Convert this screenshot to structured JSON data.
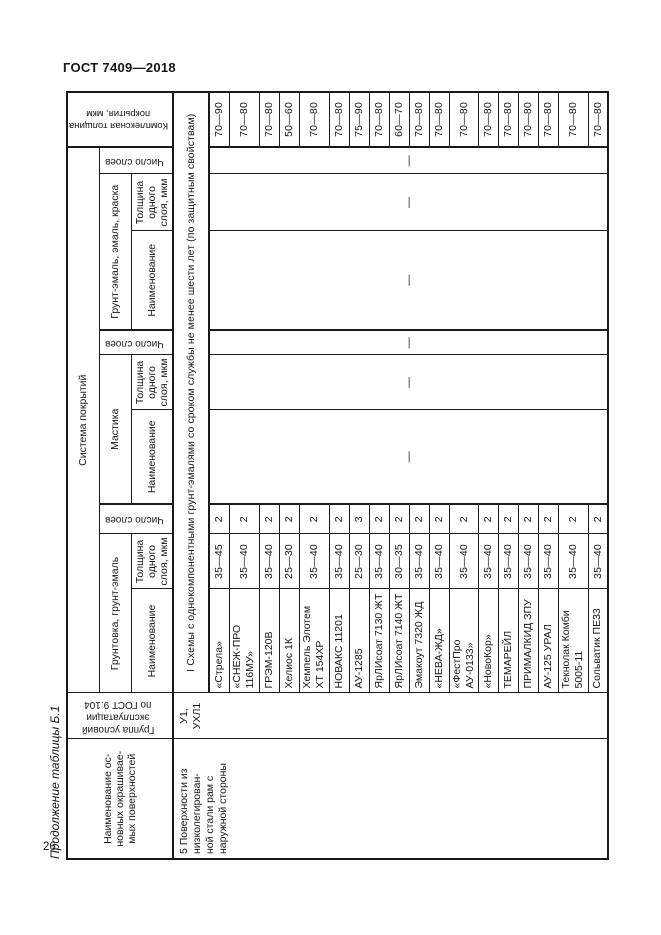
{
  "page": {
    "doc_code": "ГОСТ 7409—2018",
    "page_number": "26",
    "table_caption": "Продолжение таблицы Б.1"
  },
  "table": {
    "headers": {
      "surfaces": "Наименование ос-\nновных окрашивае-\nмых поверхностей",
      "service_group": "Группа условий\nэксплуатации\nпо ГОСТ 9.104",
      "system": "Система покрытий",
      "total_thickness": "Комплексная толщина\nпокрытия, мкм",
      "name": "Наименование",
      "layer_thickness": "Толщина\nодного\nслоя, мкм",
      "layer_count": "Число слоев",
      "group_primer": "Грунтовка, грунт-эмаль",
      "group_mastic": "Мастика",
      "group_enamel": "Грунт-эмаль, эмаль, краска"
    },
    "section_label": "I Схемы с однокомпонентными грунт-эмалями со сроком службы не менее шести лет (по защитным свойствам)",
    "row_group": {
      "surface": "5 Поверхности из\nнизколегирован-\nной стали рам с\nнаружной стороны",
      "conditions": "У1,\nУХЛ1"
    },
    "dash": "—",
    "rows": [
      {
        "name": "«Стрела»",
        "thickness": "35—45",
        "layers": "2",
        "total": "70—90"
      },
      {
        "name": "«СНЕЖ-ПРО\n116МУ»",
        "thickness": "35—40",
        "layers": "2",
        "total": "70—80"
      },
      {
        "name": "ГРЭМ-120В",
        "thickness": "35—40",
        "layers": "2",
        "total": "70—80"
      },
      {
        "name": "Хелиос 1К",
        "thickness": "25—30",
        "layers": "2",
        "total": "50—60"
      },
      {
        "name": "Хемпель Элотем\nХТ 154ХР",
        "thickness": "35—40",
        "layers": "2",
        "total": "70—80"
      },
      {
        "name": "НОВАКС 11201",
        "thickness": "35—40",
        "layers": "2",
        "total": "70—80"
      },
      {
        "name": "АУ-1285",
        "thickness": "25—30",
        "layers": "3",
        "total": "75—90"
      },
      {
        "name": "ЯрЛИсоат 7130 ЖТ",
        "thickness": "35—40",
        "layers": "2",
        "total": "70—80"
      },
      {
        "name": "ЯрЛИсоат 7140 ЖТ",
        "thickness": "30—35",
        "layers": "2",
        "total": "60—70"
      },
      {
        "name": "Эмакоут 7320 ЖД",
        "thickness": "35—40",
        "layers": "2",
        "total": "70—80"
      },
      {
        "name": "«НЕВА-ЖД»",
        "thickness": "35—40",
        "layers": "2",
        "total": "70—80"
      },
      {
        "name": "«ФестПро АУ-0133»",
        "thickness": "35—40",
        "layers": "2",
        "total": "70—80"
      },
      {
        "name": "«НовоКор»",
        "thickness": "35—40",
        "layers": "2",
        "total": "70—80"
      },
      {
        "name": "ТЕМАРЕЙЛ",
        "thickness": "35—40",
        "layers": "2",
        "total": "70—80"
      },
      {
        "name": "ПРИМАЛКИД ЗПУ",
        "thickness": "35—40",
        "layers": "2",
        "total": "70—80"
      },
      {
        "name": "АУ-125 УРАЛ",
        "thickness": "35—40",
        "layers": "2",
        "total": "70—80"
      },
      {
        "name": "Текнолак Комби\n5005-11",
        "thickness": "35—40",
        "layers": "2",
        "total": "70—80"
      },
      {
        "name": "Сольватик ПЕ33",
        "thickness": "35—40",
        "layers": "2",
        "total": "70—80"
      }
    ]
  }
}
